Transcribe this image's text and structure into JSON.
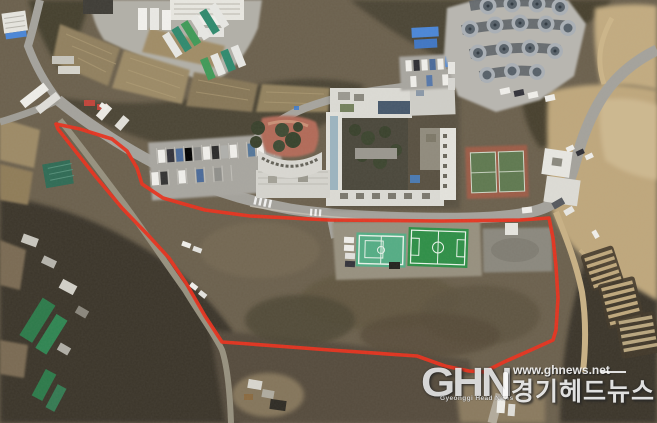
{
  "image": {
    "type": "aerial-satellite-photo",
    "width": 657,
    "height": 423
  },
  "watermark": {
    "logo": "GHN",
    "tagline": "Gyeonggi Head News",
    "url": "www.ghnews.net",
    "korean_name": "경기헤드뉴스"
  },
  "annotation": {
    "name": "site-boundary-outline",
    "color": "#e8321e",
    "boundary_points": "56,124 80,129 112,139 127,151 137,168 142,184 163,198 205,210 250,216 330,220 440,221 520,220 549,218 553,238 556,266 558,298 556,330 553,340 531,350 504,362 484,372 469,371 445,366 417,356 330,350 250,344 222,342 205,316 186,283 169,258 148,235 122,208 96,177 73,148 58,129"
  },
  "colors": {
    "boundary_red": "#e8321e",
    "soccer_green": "#2e8f47",
    "futsal_green": "#54ad85",
    "tennis_clay": "#9c5c46",
    "tennis_court_green": "#5f7950",
    "road_gray": "#a4a29c",
    "dirt_tan": "#bfa77c",
    "woods_dark": "#3b3529",
    "roof_blue": "#4a86d8",
    "building_white": "#dcdbd5",
    "greenhouse_green": "#2c7a4a"
  },
  "features": [
    {
      "name": "truck-depot",
      "desc": "yard with parked trucks and buses along the top edge"
    },
    {
      "name": "farm-plots",
      "desc": "terraced farmland strips below the depot"
    },
    {
      "name": "institution-building",
      "desc": "large white building complex with inner courtyard and blue roof panels"
    },
    {
      "name": "playground",
      "desc": "reddish playground with trees beside curved building wing"
    },
    {
      "name": "tank-facility",
      "desc": "fan-shaped facility with rows of circular tanks, top right"
    },
    {
      "name": "tennis-court",
      "desc": "two green courts on clay-colored base"
    },
    {
      "name": "soccer-field",
      "desc": "green pitch with white markings"
    },
    {
      "name": "futsal-court",
      "desc": "light green court with white markings"
    },
    {
      "name": "central-parking-lot",
      "desc": "gray parking lot with rows of cars"
    },
    {
      "name": "north-parking-lot",
      "desc": "parking rows behind the building"
    },
    {
      "name": "greenhouses",
      "desc": "green-roofed greenhouses in dark wooded area, lower left"
    },
    {
      "name": "terraced-structures",
      "desc": "stepped terrace rows on hillside, lower right"
    },
    {
      "name": "dirt-slope",
      "desc": "bare tan slope with dirt road, right side"
    },
    {
      "name": "main-road",
      "desc": "gray road crossing the scene from left to upper right"
    },
    {
      "name": "site-boundary-outline",
      "desc": "red outline enclosing the lower site area"
    }
  ]
}
